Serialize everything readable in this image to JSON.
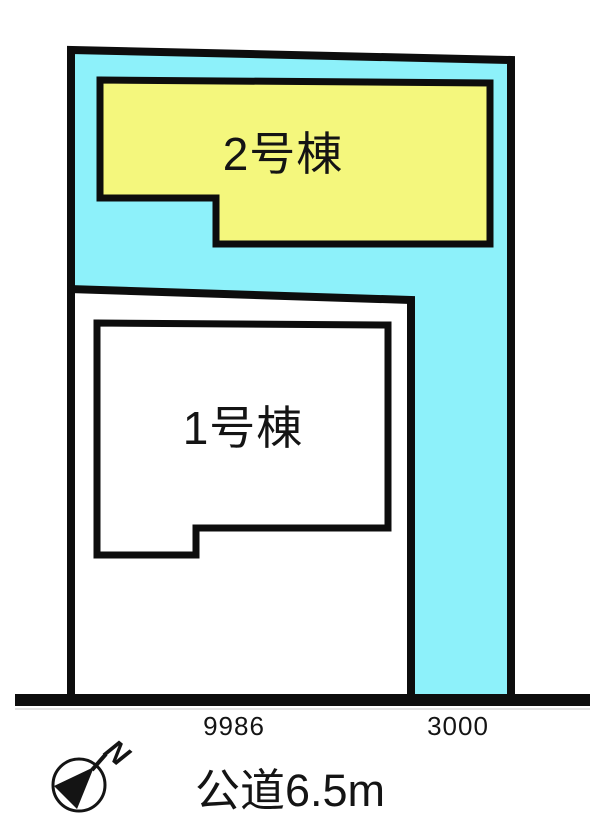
{
  "site_plan": {
    "buildings": [
      {
        "label": "2号棟"
      },
      {
        "label": "1号棟"
      }
    ],
    "dimensions": [
      {
        "label": "9986"
      },
      {
        "label": "3000"
      }
    ],
    "road_label": "公道6.5m",
    "compass_north": "N",
    "colors": {
      "lot_fill": "#8df1fa",
      "building2_fill": "#f4f77d",
      "building1_fill": "#ffffff",
      "outline": "#0d0d0d"
    }
  }
}
